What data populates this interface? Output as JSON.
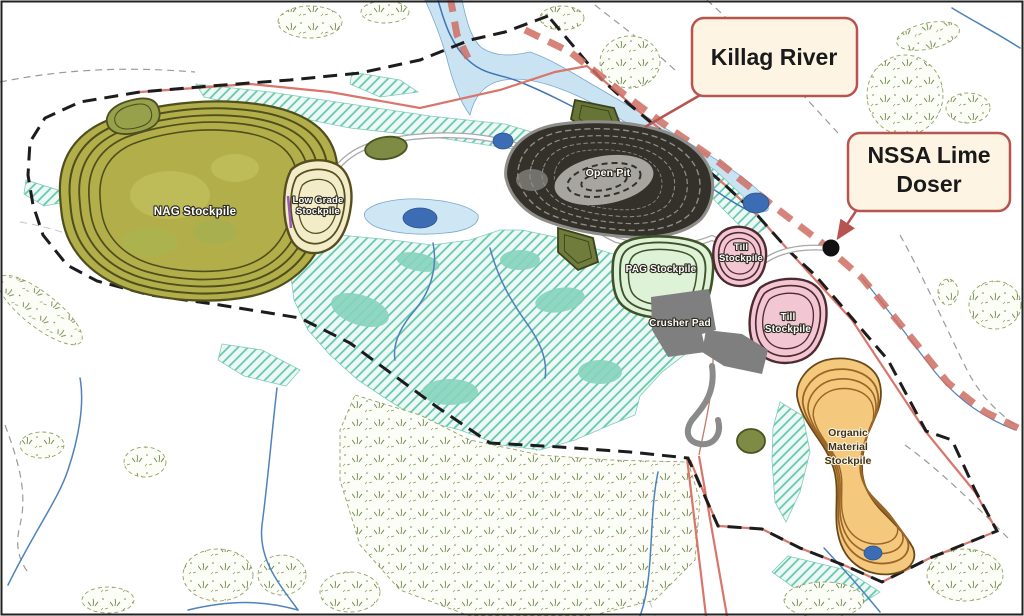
{
  "map": {
    "type": "mine-site-plan",
    "facilities": {
      "nag": {
        "name": "NAG Stockpile"
      },
      "low_grade": {
        "line1": "Low Grade",
        "line2": "Stockpile"
      },
      "open_pit": {
        "name": "Open Pit"
      },
      "pag": {
        "name": "PAG Stockpile"
      },
      "till_north": {
        "line1": "Till",
        "line2": "Stockpile"
      },
      "till_south": {
        "line1": "Till",
        "line2": "Stockpile"
      },
      "crusher_pad": {
        "name": "Crusher Pad"
      },
      "organic": {
        "line1": "Organic",
        "line2": "Material",
        "line3": "Stockpile"
      }
    },
    "callouts": {
      "killag_river": {
        "text": "Killag River"
      },
      "nssa_lime_doser": {
        "line1": "NSSA Lime",
        "line2": "Doser"
      }
    },
    "colors": {
      "canvas_bg": "#ffffff",
      "frame": "#222222",
      "water_light": "#c9e3f2",
      "water_outline": "#7aa8cf",
      "stream": "#4d82bd",
      "pond": "#3c6cb4",
      "wetland_hatch": "#5fc7ab",
      "wetland_solid": "#86d4bd",
      "veg_outline": "#93a264",
      "veg_mark": "#6f8a4b",
      "boundary_black": "#1c1c1c",
      "red_line": "#d9756a",
      "river_highlight": "#cf6f63",
      "road_casing": "#a8a8a8",
      "road_fill": "#ffffff",
      "nag_fill": "#b2af4a",
      "nag_contour": "#4f4e1e",
      "pad_green_fill": "#7d8b44",
      "low_grade_fill": "#f2ecc8",
      "low_grade_contour": "#574e1f",
      "open_pit_fill": "#34312b",
      "open_pit_bench": "#8e8d89",
      "open_pit_inner": "#a7a5a0",
      "pag_fill": "#def2d8",
      "pag_contour": "#3d5226",
      "till_fill": "#f2c6d2",
      "till_contour": "#4f2930",
      "organic_fill": "#f4c87d",
      "organic_contour": "#9a6526",
      "crusher_fill": "#7f7f7f",
      "callout_bg": "#fdf4e4",
      "callout_border": "#b85450",
      "callout_text": "#1a1a1a",
      "doser_dot": "#111111"
    }
  }
}
